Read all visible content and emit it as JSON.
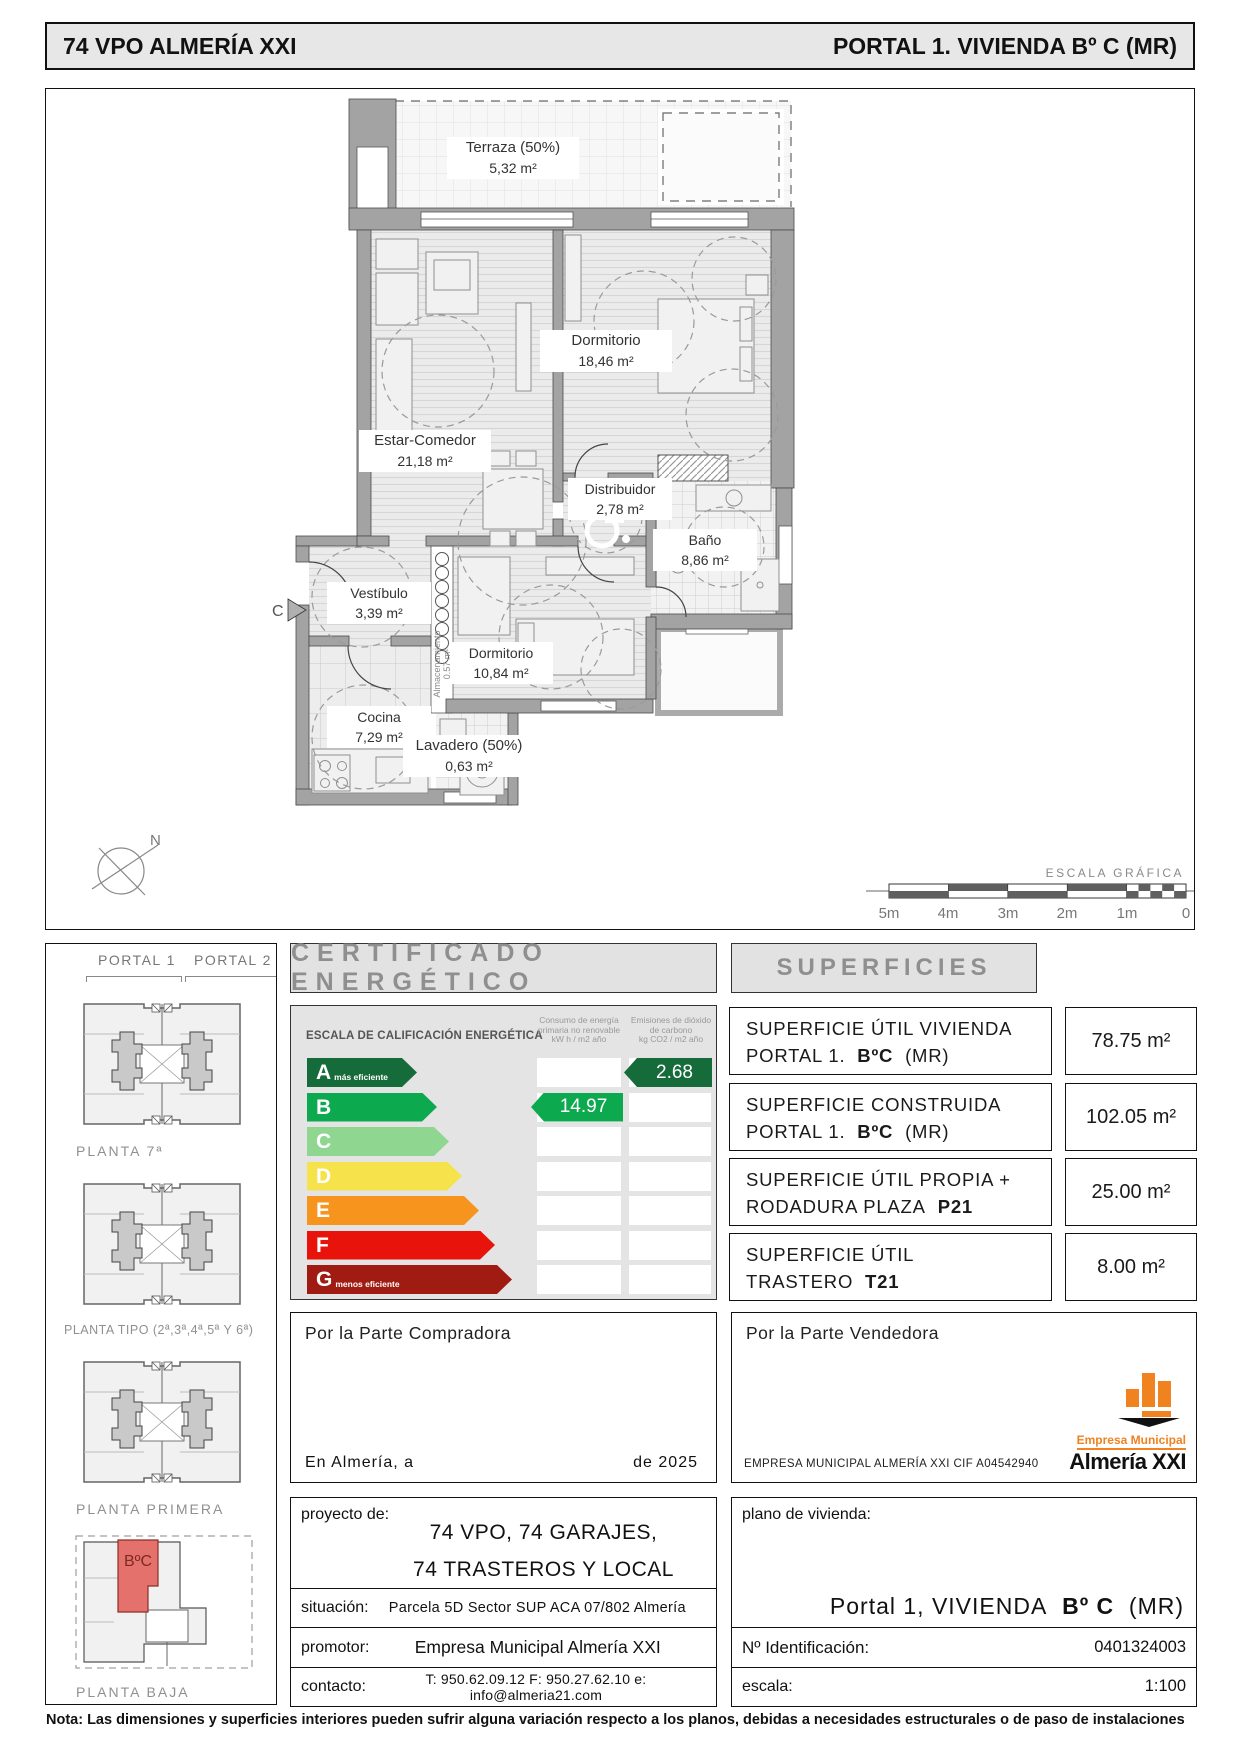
{
  "header": {
    "left_title": "74  VPO  ALMERÍA  XXI",
    "right_title": "PORTAL  1.  VIVIENDA  Bº C  (MR)"
  },
  "floorplan": {
    "rooms": [
      {
        "name": "Terraza (50%)",
        "area": "5,32 m²"
      },
      {
        "name": "Dormitorio",
        "area": "18,46 m²"
      },
      {
        "name": "Estar-Comedor",
        "area": "21,18 m²"
      },
      {
        "name": "Distribuidor",
        "area": "2,78 m²"
      },
      {
        "name": "Baño",
        "area": "8,86 m²"
      },
      {
        "name": "Vestíbulo",
        "area": "3,39 m²"
      },
      {
        "name": "Dormitorio",
        "area": "10,84 m²"
      },
      {
        "name": "Cocina",
        "area": "7,29 m²"
      },
      {
        "name": "Lavadero (50%)",
        "area": "0,63 m²"
      },
      {
        "name": "Almacenamiento",
        "area": "0.57 m²"
      }
    ],
    "section_marker": "C",
    "north": "N",
    "scale": {
      "title": "ESCALA  GRÁFICA",
      "ticks": [
        "5m",
        "4m",
        "3m",
        "2m",
        "1m",
        "0"
      ]
    }
  },
  "sidebar": {
    "portals": [
      "PORTAL 1",
      "PORTAL 2"
    ],
    "floor_labels": [
      "PLANTA 7ª",
      "PLANTA TIPO (2ª,3ª,4ª,5ª Y 6ª)",
      "PLANTA PRIMERA",
      "PLANTA BAJA"
    ],
    "unit_highlight": "BºC"
  },
  "certificate": {
    "title": "CERTIFICADO ENERGÉTICO",
    "scale_title": "ESCALA DE CALIFICACIÓN ENERGÉTICA",
    "col_consumption": "Consumo de energía primaria no renovable",
    "col_consumption_units": "kW h / m2 año",
    "col_emissions": "Emisiones de dióxido de carbono",
    "col_emissions_units": "kg CO2 / m2 año",
    "ratings": [
      {
        "letter": "A",
        "note": "más eficiente",
        "color": "#156b39"
      },
      {
        "letter": "B",
        "note": "",
        "color": "#0ca94f"
      },
      {
        "letter": "C",
        "note": "",
        "color": "#8fd690"
      },
      {
        "letter": "D",
        "note": "",
        "color": "#f6e24b"
      },
      {
        "letter": "E",
        "note": "",
        "color": "#f7941e"
      },
      {
        "letter": "F",
        "note": "",
        "color": "#e8140c"
      },
      {
        "letter": "G",
        "note": "menos eficiente",
        "color": "#a01b12"
      }
    ],
    "consumption_value": "14.97",
    "consumption_rating": "B",
    "emissions_value": "2.68",
    "emissions_rating": "A"
  },
  "superficies": {
    "title": "SUPERFICIES",
    "rows": [
      {
        "l1": "SUPERFICIE  ÚTIL  VIVIENDA",
        "l2pre": "PORTAL  1.",
        "l2bold": "BºC",
        "l2post": "(MR)",
        "value": "78.75 m²"
      },
      {
        "l1": "SUPERFICIE  CONSTRUIDA",
        "l2pre": "PORTAL  1.",
        "l2bold": "BºC",
        "l2post": "(MR)",
        "value": "102.05 m²"
      },
      {
        "l1": "SUPERFICIE  ÚTIL  PROPIA +",
        "l2pre": "RODADURA  PLAZA",
        "l2bold": "P21",
        "l2post": "",
        "value": "25.00 m²"
      },
      {
        "l1": "SUPERFICIE  ÚTIL",
        "l2pre": "TRASTERO",
        "l2bold": "T21",
        "l2post": "",
        "value": "8.00 m²"
      }
    ]
  },
  "signatures": {
    "buyer": {
      "title": "Por la Parte Compradora",
      "line_left": "En  Almería,  a",
      "line_right": "de  2025"
    },
    "seller": {
      "title": "Por la Parte Vendedora",
      "company": "EMPRESA MUNICIPAL ALMERÍA XXI    CIF  A04542940",
      "logo_top": "Empresa Municipal",
      "logo_bottom": "Almería XXI"
    }
  },
  "project": {
    "proyecto_label": "proyecto de:",
    "proyecto_line1": "74 VPO, 74 GARAJES,",
    "proyecto_line2": "74 TRASTEROS Y LOCAL",
    "situacion_label": "situación:",
    "situacion_value": "Parcela 5D Sector SUP ACA 07/802 Almería",
    "promotor_label": "promotor:",
    "promotor_value": "Empresa Municipal Almería XXI",
    "contacto_label": "contacto:",
    "contacto_value": "T:  950.62.09.12   F:  950.27.62.10   e:  info@almeria21.com",
    "plano_label": "plano de vivienda:",
    "plano_pre": "Portal  1,  VIVIENDA",
    "plano_bold": "Bº C",
    "plano_post": "(MR)",
    "id_label": "Nº Identificación:",
    "id_value": "0401324003",
    "escala_label": "escala:",
    "escala_value": "1:100"
  },
  "footer_note": "Nota: Las dimensiones y superficies interiores pueden sufrir alguna variación respecto a los planos, debidas a necesidades estructurales o de paso de instalaciones",
  "colors": {
    "unit_highlight_fill": "#e4716b",
    "logo_orange": "#f08220",
    "header_bg": "#e7e7e7"
  }
}
